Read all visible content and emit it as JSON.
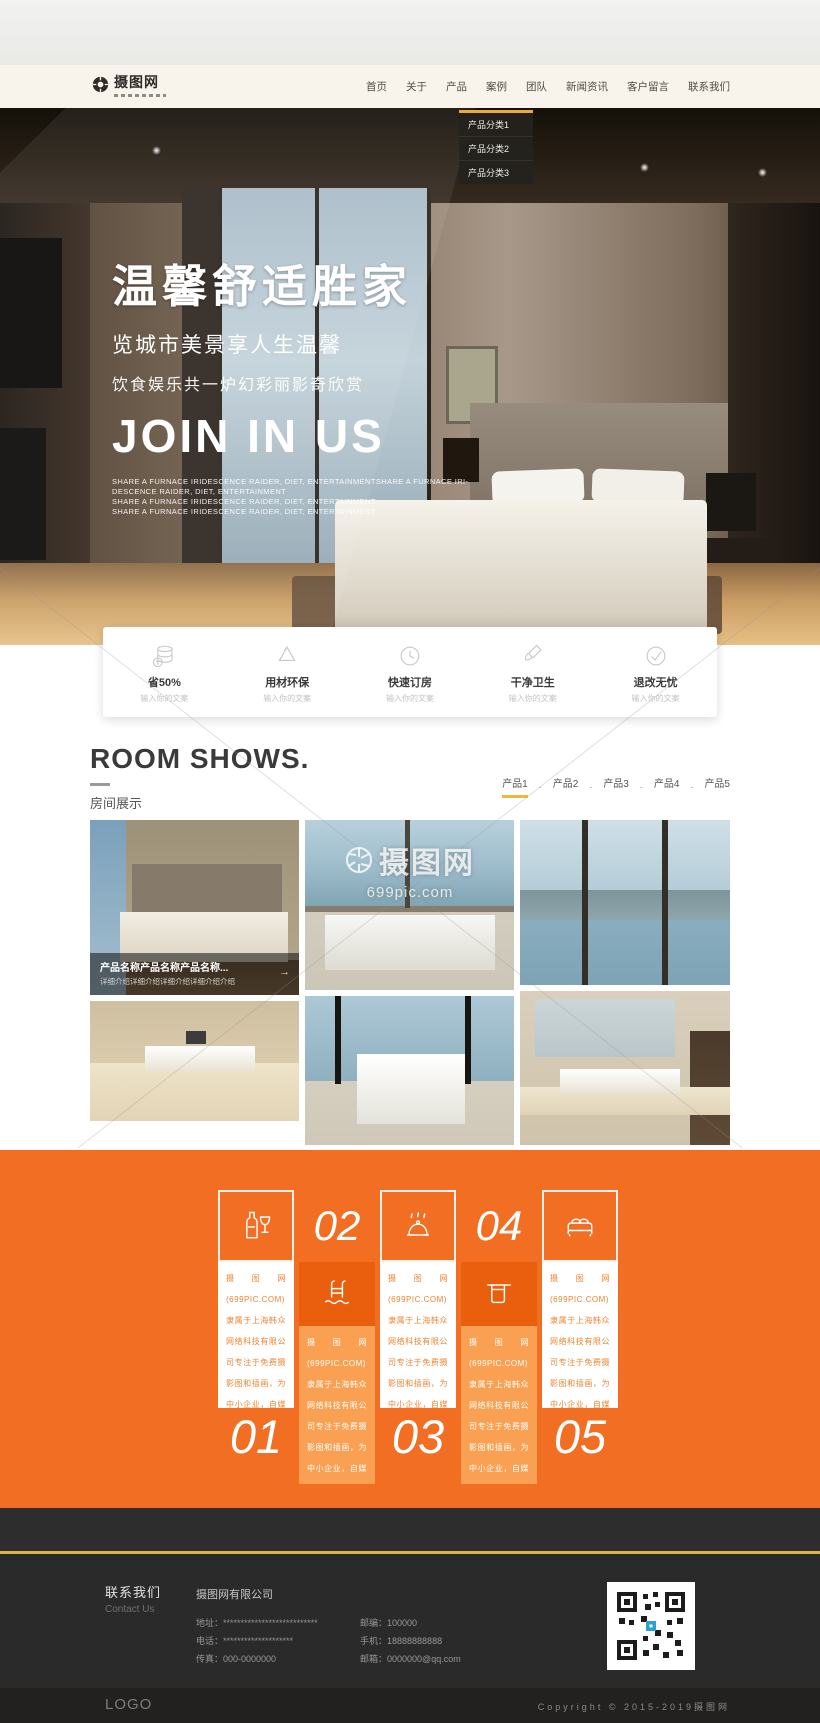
{
  "header": {
    "logo": "摄图网",
    "nav": [
      "首页",
      "关于",
      "产品",
      "案例",
      "团队",
      "新闻资讯",
      "客户留言",
      "联系我们"
    ],
    "dropdown": [
      "产品分类1",
      "产品分类2",
      "产品分类3"
    ]
  },
  "hero": {
    "title": "温馨舒适胜家",
    "subtitle1": "览城市美景享人生温馨",
    "subtitle2": "饮食娱乐共一炉幻彩丽影奇欣赏",
    "slogan_en": "JOIN IN US",
    "desc_lines": [
      "SHARE A FURNACE IRIDESCENCE RAIDER, DIET, ENTERTAINMENTSHARE A FURNACE IRI-",
      "DESCENCE RAIDER, DIET, ENTERTAINMENT",
      "SHARE A FURNACE IRIDESCENCE RAIDER, DIET, ENTERTAINMENT",
      "SHARE A FURNACE IRIDESCENCE RAIDER, DIET, ENTERTAINMENT"
    ]
  },
  "features": {
    "items": [
      {
        "icon": "coins-icon",
        "title": "省50%",
        "sub": "输入你的文案"
      },
      {
        "icon": "recycle-icon",
        "title": "用材环保",
        "sub": "输入你的文案"
      },
      {
        "icon": "clock-icon",
        "title": "快速订房",
        "sub": "输入你的文案"
      },
      {
        "icon": "brush-icon",
        "title": "干净卫生",
        "sub": "输入你的文案"
      },
      {
        "icon": "check-icon",
        "title": "退改无忧",
        "sub": "输入你的文案"
      }
    ]
  },
  "rooms": {
    "title_en": "ROOM SHOWS.",
    "title_cn": "房间展示",
    "tabs": [
      "产品1",
      "产品2",
      "产品3",
      "产品4",
      "产品5"
    ],
    "tab_separator": "-",
    "active_tab_index": 0,
    "caption": {
      "title": "产品名称产品名称产品名称...",
      "desc": "详细介绍详细介绍详细介绍详细介绍介绍",
      "arrow": "→"
    },
    "watermark": {
      "brand": "摄图网",
      "url": "699pic.com"
    }
  },
  "services": {
    "numbers": [
      "01",
      "02",
      "03",
      "04",
      "05"
    ],
    "blurb": "摄图网(699PIC.COM)隶属于上海韩众网络科技有限公司专注于免费摄影图和插画，为中小企业，自媒体，设计师，运营等提供优质的服务！"
  },
  "footer": {
    "contact_cn": "联系我们",
    "contact_en": "Contact Us",
    "company": "摄图网有限公司",
    "left_rows": [
      {
        "label": "地址：",
        "value": "***************************"
      },
      {
        "label": "电话：",
        "value": "********************"
      },
      {
        "label": "传真：",
        "value": "000-0000000"
      }
    ],
    "right_rows": [
      {
        "label": "邮编：",
        "value": "100000"
      },
      {
        "label": "手机：",
        "value": "18888888888"
      },
      {
        "label": "邮箱：",
        "value": "0000000@qq.com"
      }
    ],
    "logo": "LOGO",
    "copyright": "Copyright © 2015-2019摄图网"
  },
  "colors": {
    "accent_orange": "#f26e22",
    "accent_gold": "#f0b63f",
    "header_cream": "#f8f4ec",
    "footer_dark": "#2a2a2a"
  }
}
